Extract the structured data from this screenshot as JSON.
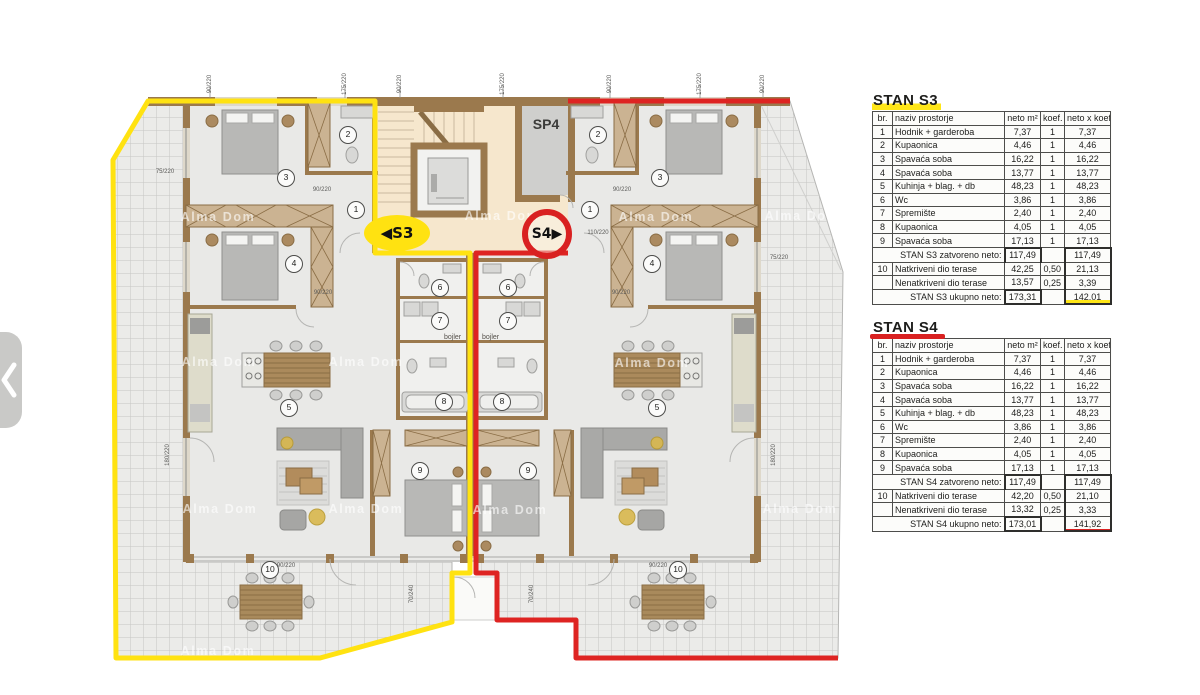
{
  "icons": {
    "gallery_prev": "chevron-left"
  },
  "colors": {
    "s3_accent": "#ffe211",
    "s4_accent": "#d92121",
    "wall": "#9b794d"
  },
  "plan": {
    "sp4": "SP4",
    "badge_s3": "◀S3",
    "badge_s4": "S4▶",
    "bojler_left": "bojler",
    "bojler_right": "bojler",
    "watermark_text": "Alma Dom",
    "watermarks": [
      [
        218,
        217
      ],
      [
        502,
        216
      ],
      [
        656,
        217
      ],
      [
        802,
        216
      ],
      [
        219,
        362
      ],
      [
        366,
        362
      ],
      [
        652,
        363
      ],
      [
        220,
        509
      ],
      [
        366,
        509
      ],
      [
        510,
        510
      ],
      [
        800,
        509
      ],
      [
        218,
        651
      ]
    ],
    "rooms": [
      {
        "n": "1",
        "x": 355,
        "y": 209
      },
      {
        "n": "2",
        "x": 347,
        "y": 134
      },
      {
        "n": "3",
        "x": 285,
        "y": 177
      },
      {
        "n": "4",
        "x": 293,
        "y": 263
      },
      {
        "n": "5",
        "x": 288,
        "y": 407
      },
      {
        "n": "6",
        "x": 439,
        "y": 287
      },
      {
        "n": "7",
        "x": 439,
        "y": 320
      },
      {
        "n": "8",
        "x": 443,
        "y": 401
      },
      {
        "n": "9",
        "x": 419,
        "y": 470
      },
      {
        "n": "10",
        "x": 269,
        "y": 569
      },
      {
        "n": "1",
        "x": 589,
        "y": 209
      },
      {
        "n": "2",
        "x": 597,
        "y": 134
      },
      {
        "n": "3",
        "x": 659,
        "y": 177
      },
      {
        "n": "4",
        "x": 651,
        "y": 263
      },
      {
        "n": "5",
        "x": 656,
        "y": 407
      },
      {
        "n": "6",
        "x": 507,
        "y": 287
      },
      {
        "n": "7",
        "x": 507,
        "y": 320
      },
      {
        "n": "8",
        "x": 501,
        "y": 401
      },
      {
        "n": "9",
        "x": 527,
        "y": 470
      },
      {
        "n": "10",
        "x": 677,
        "y": 569
      }
    ],
    "dims": [
      {
        "t": "90/220",
        "x": 210,
        "y": 84,
        "r": -90
      },
      {
        "t": "175/220",
        "x": 345,
        "y": 84,
        "r": -90
      },
      {
        "t": "90/220",
        "x": 400,
        "y": 84,
        "r": -90
      },
      {
        "t": "175/220",
        "x": 503,
        "y": 84,
        "r": -90
      },
      {
        "t": "90/220",
        "x": 610,
        "y": 84,
        "r": -90
      },
      {
        "t": "175/220",
        "x": 700,
        "y": 84,
        "r": -90
      },
      {
        "t": "90/220",
        "x": 763,
        "y": 84,
        "r": -90
      },
      {
        "t": "90/220",
        "x": 322,
        "y": 190,
        "r": 0
      },
      {
        "t": "90/220",
        "x": 622,
        "y": 190,
        "r": 0
      },
      {
        "t": "90/220",
        "x": 323,
        "y": 293,
        "r": 0
      },
      {
        "t": "90/220",
        "x": 621,
        "y": 293,
        "r": 0
      },
      {
        "t": "75/220",
        "x": 165,
        "y": 172,
        "r": 0
      },
      {
        "t": "75/220",
        "x": 779,
        "y": 258,
        "r": 0
      },
      {
        "t": "110/220",
        "x": 598,
        "y": 233,
        "r": 0
      },
      {
        "t": "180/220",
        "x": 168,
        "y": 455,
        "r": -90
      },
      {
        "t": "180/220",
        "x": 774,
        "y": 455,
        "r": -90
      },
      {
        "t": "70/240",
        "x": 412,
        "y": 594,
        "r": -90
      },
      {
        "t": "70/240",
        "x": 532,
        "y": 594,
        "r": -90
      },
      {
        "t": "90/220",
        "x": 286,
        "y": 566,
        "r": 0
      },
      {
        "t": "90/220",
        "x": 658,
        "y": 566,
        "r": 0
      }
    ]
  },
  "tables": [
    {
      "name": "STAN S3",
      "accent": "yellow",
      "headers": [
        "br.",
        "naziv prostorje",
        "neto m²",
        "koef.",
        "neto x koef. m²"
      ],
      "rows": [
        [
          "1",
          "Hodnik + garderoba",
          "7,37",
          "1",
          "7,37"
        ],
        [
          "2",
          "Kupaonica",
          "4,46",
          "1",
          "4,46"
        ],
        [
          "3",
          "Spavaća soba",
          "16,22",
          "1",
          "16,22"
        ],
        [
          "4",
          "Spavaća soba",
          "13,77",
          "1",
          "13,77"
        ],
        [
          "5",
          "Kuhinja + blag. + db",
          "48,23",
          "1",
          "48,23"
        ],
        [
          "6",
          "Wc",
          "3,86",
          "1",
          "3,86"
        ],
        [
          "7",
          "Spremište",
          "2,40",
          "1",
          "2,40"
        ],
        [
          "8",
          "Kupaonica",
          "4,05",
          "1",
          "4,05"
        ],
        [
          "9",
          "Spavaća soba",
          "17,13",
          "1",
          "17,13"
        ]
      ],
      "closed_label": "STAN S3 zatvoreno neto:",
      "closed_neto": "117,49",
      "closed_total": "117,49",
      "terrace_rows": [
        [
          "10",
          "Natkriveni dio terase",
          "42,25",
          "0,50",
          "21,13"
        ],
        [
          "",
          "Nenatkriveni dio terase",
          "13,57",
          "0,25",
          "3,39"
        ]
      ],
      "total_label": "STAN S3 ukupno neto:",
      "total_neto": "173,31",
      "total": "142,01"
    },
    {
      "name": "STAN S4",
      "accent": "red",
      "headers": [
        "br.",
        "naziv prostorje",
        "neto m²",
        "koef.",
        "neto x koef. m²"
      ],
      "rows": [
        [
          "1",
          "Hodnik + garderoba",
          "7,37",
          "1",
          "7,37"
        ],
        [
          "2",
          "Kupaonica",
          "4,46",
          "1",
          "4,46"
        ],
        [
          "3",
          "Spavaća soba",
          "16,22",
          "1",
          "16,22"
        ],
        [
          "4",
          "Spavaća soba",
          "13,77",
          "1",
          "13,77"
        ],
        [
          "5",
          "Kuhinja + blag. + db",
          "48,23",
          "1",
          "48,23"
        ],
        [
          "6",
          "Wc",
          "3,86",
          "1",
          "3,86"
        ],
        [
          "7",
          "Spremište",
          "2,40",
          "1",
          "2,40"
        ],
        [
          "8",
          "Kupaonica",
          "4,05",
          "1",
          "4,05"
        ],
        [
          "9",
          "Spavaća soba",
          "17,13",
          "1",
          "17,13"
        ]
      ],
      "closed_label": "STAN S4 zatvoreno neto:",
      "closed_neto": "117,49",
      "closed_total": "117,49",
      "terrace_rows": [
        [
          "10",
          "Natkriveni dio terase",
          "42,20",
          "0,50",
          "21,10"
        ],
        [
          "",
          "Nenatkriveni dio terase",
          "13,32",
          "0,25",
          "3,33"
        ]
      ],
      "total_label": "STAN S4 ukupno neto:",
      "total_neto": "173,01",
      "total": "141,92"
    }
  ]
}
